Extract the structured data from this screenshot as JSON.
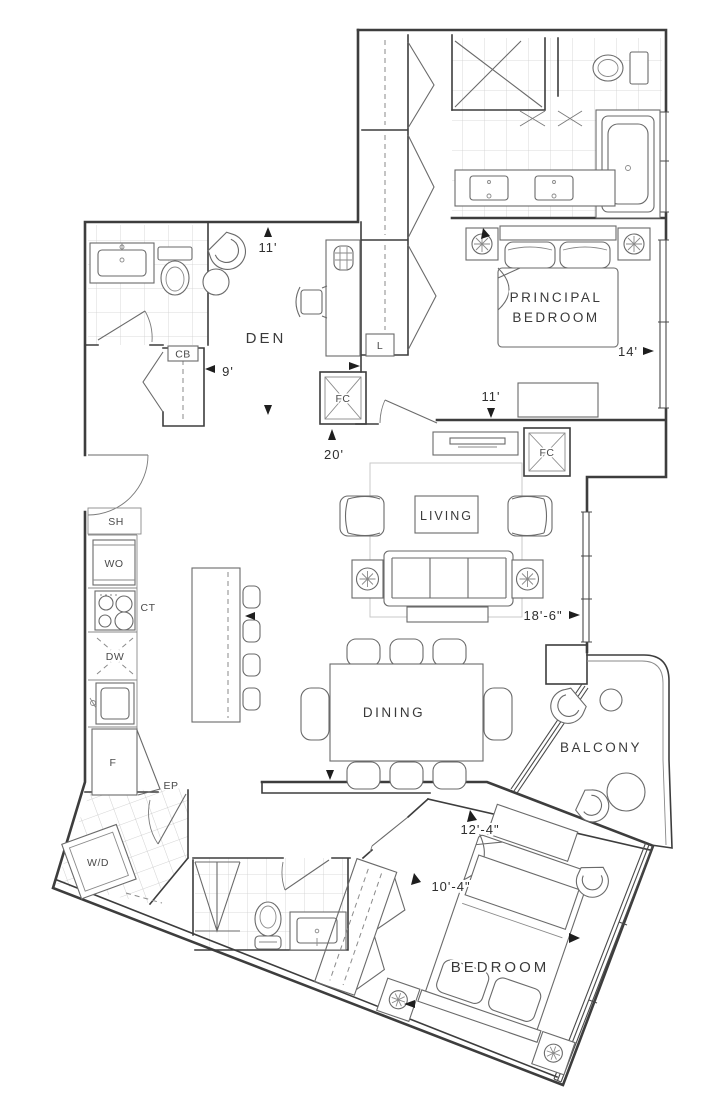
{
  "plan": {
    "background": "#ffffff",
    "line_color": "#3d3d3d"
  },
  "rooms": {
    "den": {
      "label": "DEN"
    },
    "principal_bedroom": {
      "label_line1": "PRINCIPAL",
      "label_line2": "BEDROOM"
    },
    "living": {
      "label": "LIVING"
    },
    "dining": {
      "label": "DINING"
    },
    "balcony": {
      "label": "BALCONY"
    },
    "bedroom": {
      "label": "BEDROOM"
    }
  },
  "fixtures": {
    "shelf": "SH",
    "wall_oven": "WO",
    "cooktop": "CT",
    "dishwasher": "DW",
    "fridge": "F",
    "coat_closet": "CB",
    "linen_closet": "L",
    "fan_coil": "FC",
    "electrical_panel": "EP",
    "washer_dryer": "W/D"
  },
  "dimensions": {
    "den_width": "11'",
    "den_depth": "9'",
    "gallery": "20'",
    "principal_width": "11'",
    "principal_depth": "14'",
    "living_length": "18'-6\"",
    "bedroom_length": "12'-4\"",
    "bedroom_width": "10'-4\""
  }
}
